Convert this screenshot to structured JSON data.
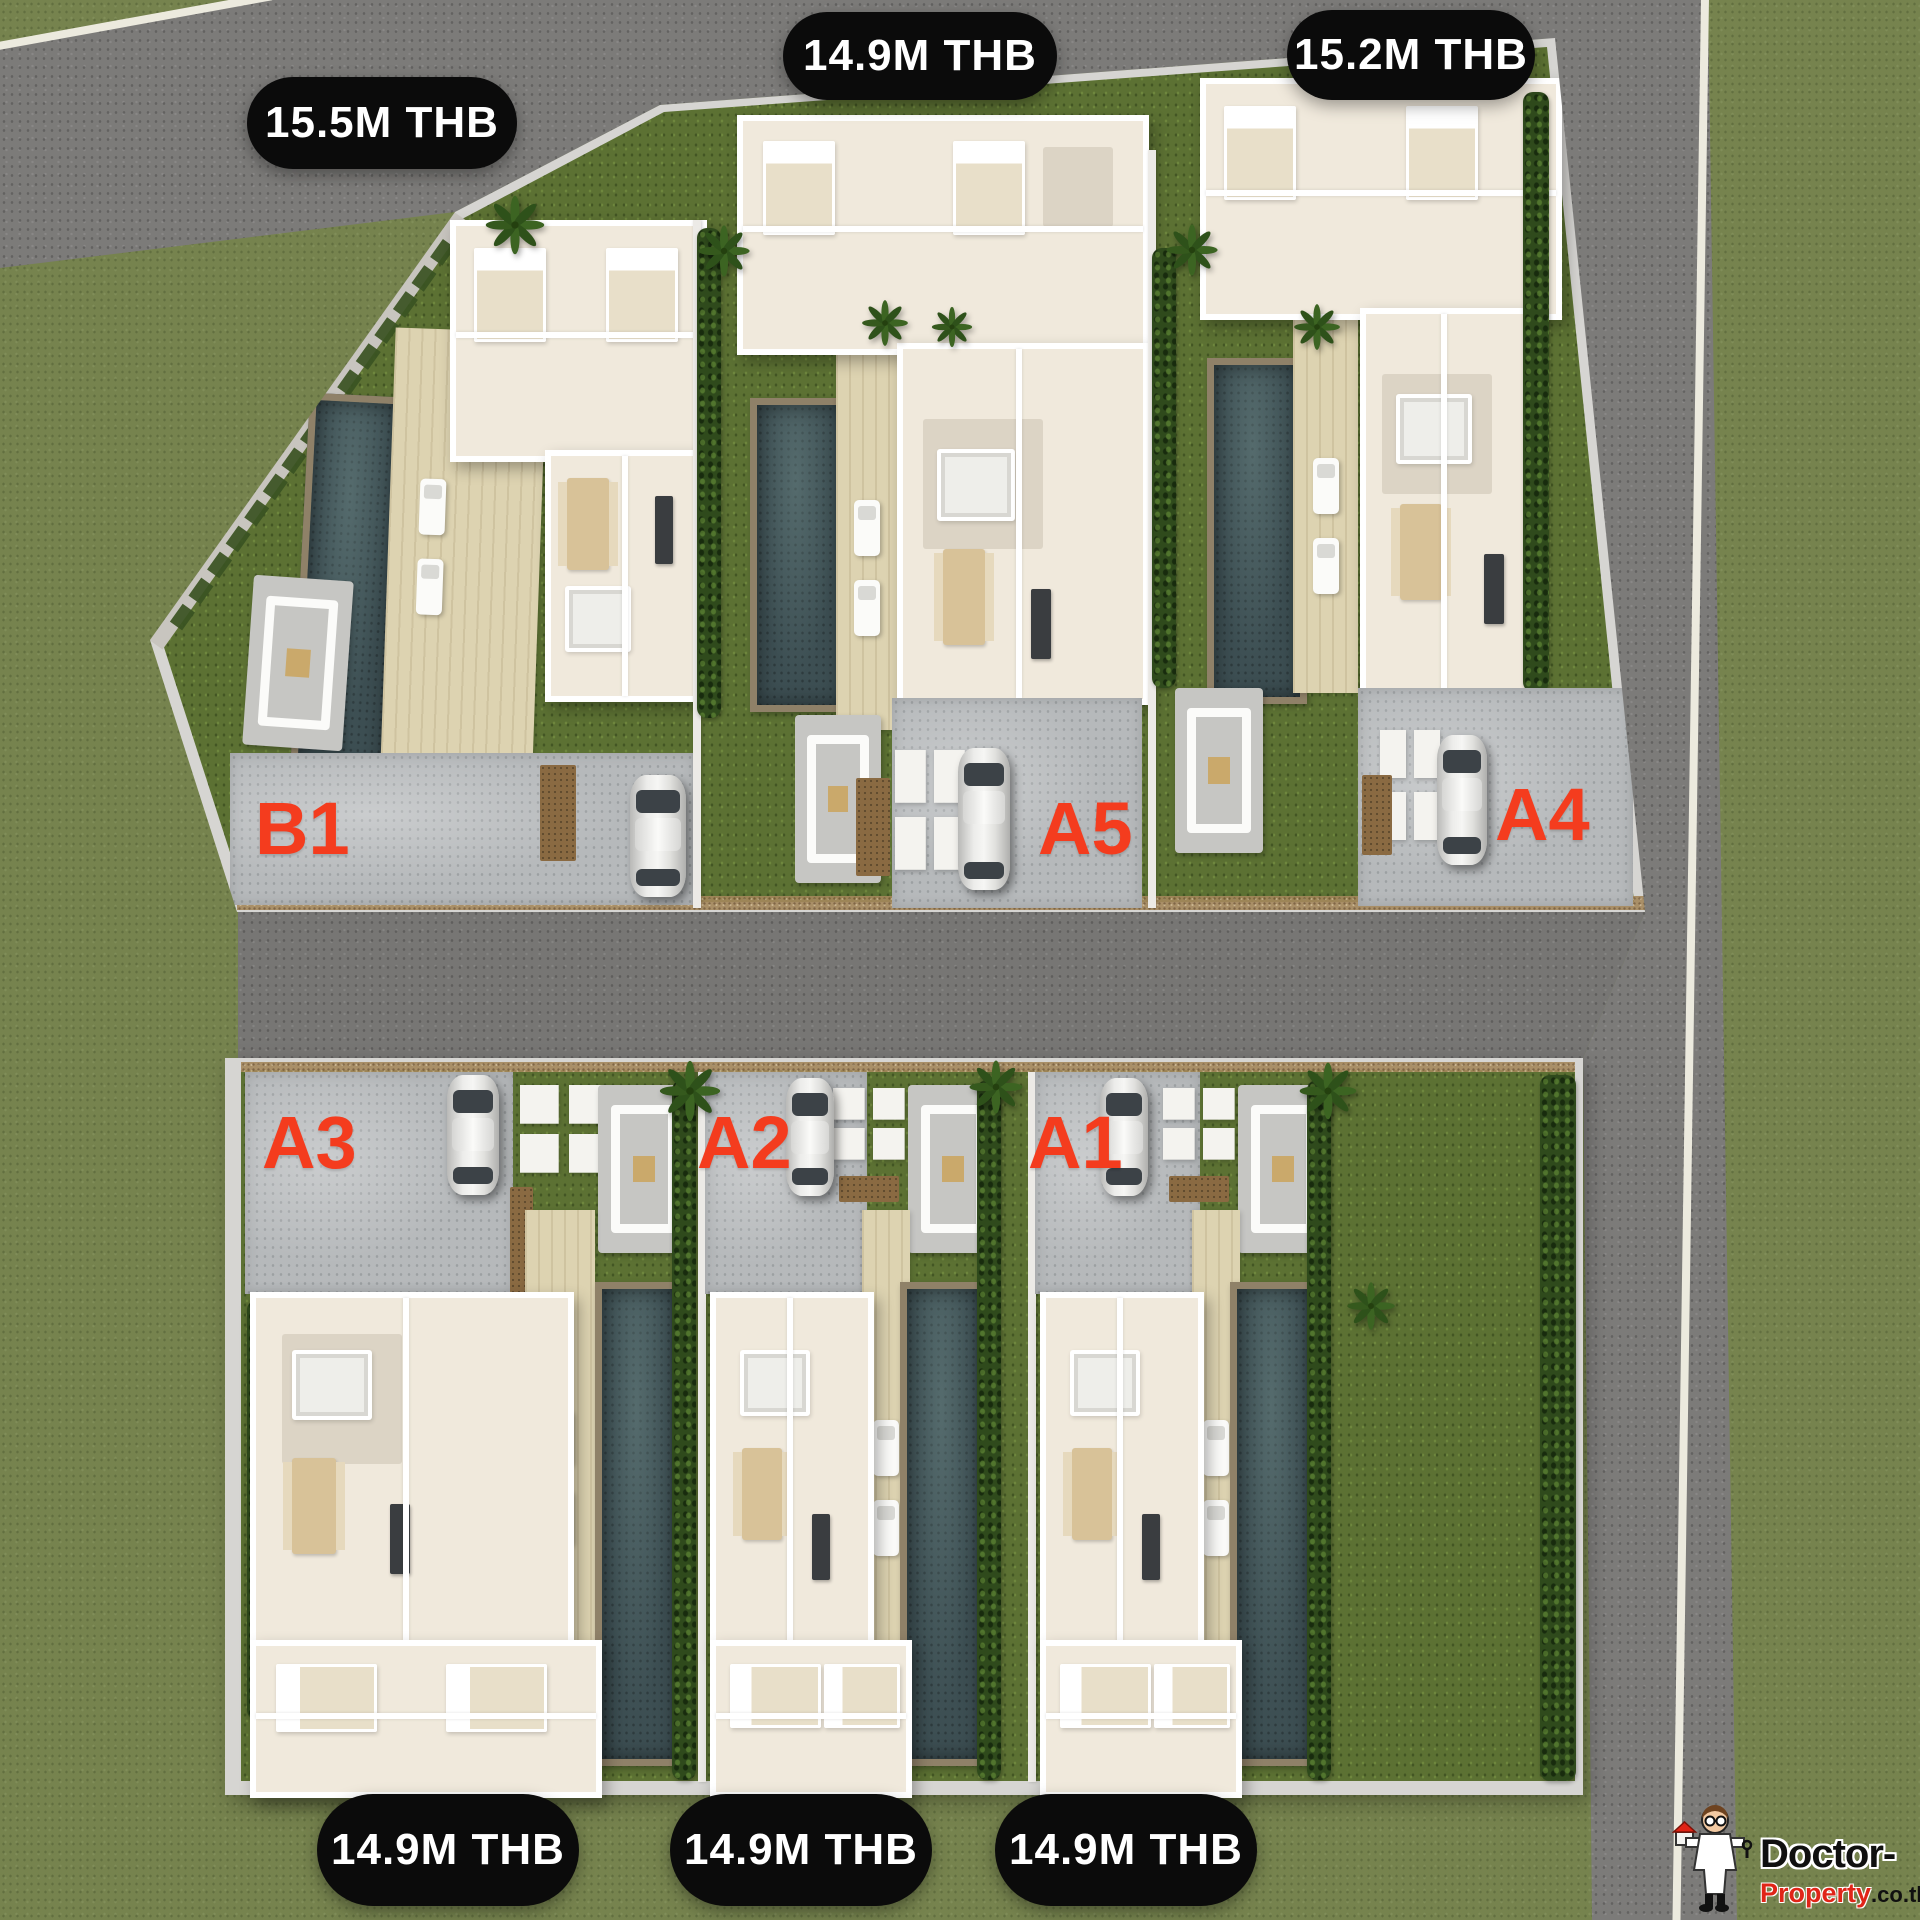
{
  "site": {
    "units": [
      {
        "id": "B1",
        "label": "B1",
        "price": "15.5M THB"
      },
      {
        "id": "A5",
        "label": "A5",
        "price": "14.9M THB"
      },
      {
        "id": "A4",
        "label": "A4",
        "price": "15.2M THB"
      },
      {
        "id": "A3",
        "label": "A3",
        "price": "14.9M THB"
      },
      {
        "id": "A2",
        "label": "A2",
        "price": "14.9M THB"
      },
      {
        "id": "A1",
        "label": "A1",
        "price": "14.9M THB"
      }
    ],
    "watermark": {
      "brand_top": "Doctor-",
      "brand_bottom": "Property",
      "brand_suffix": ".co.th"
    },
    "colors": {
      "label_red": "#f43c1e",
      "pill_bg": "#0b0b0b",
      "pill_text": "#ffffff",
      "grass_outer": "#76834e",
      "grass_garden": "#5c7133",
      "road": "#7c7b79",
      "pool_water": "#3d4f53",
      "deck": "#ddd3b1",
      "house_wall": "#ffffff"
    }
  }
}
